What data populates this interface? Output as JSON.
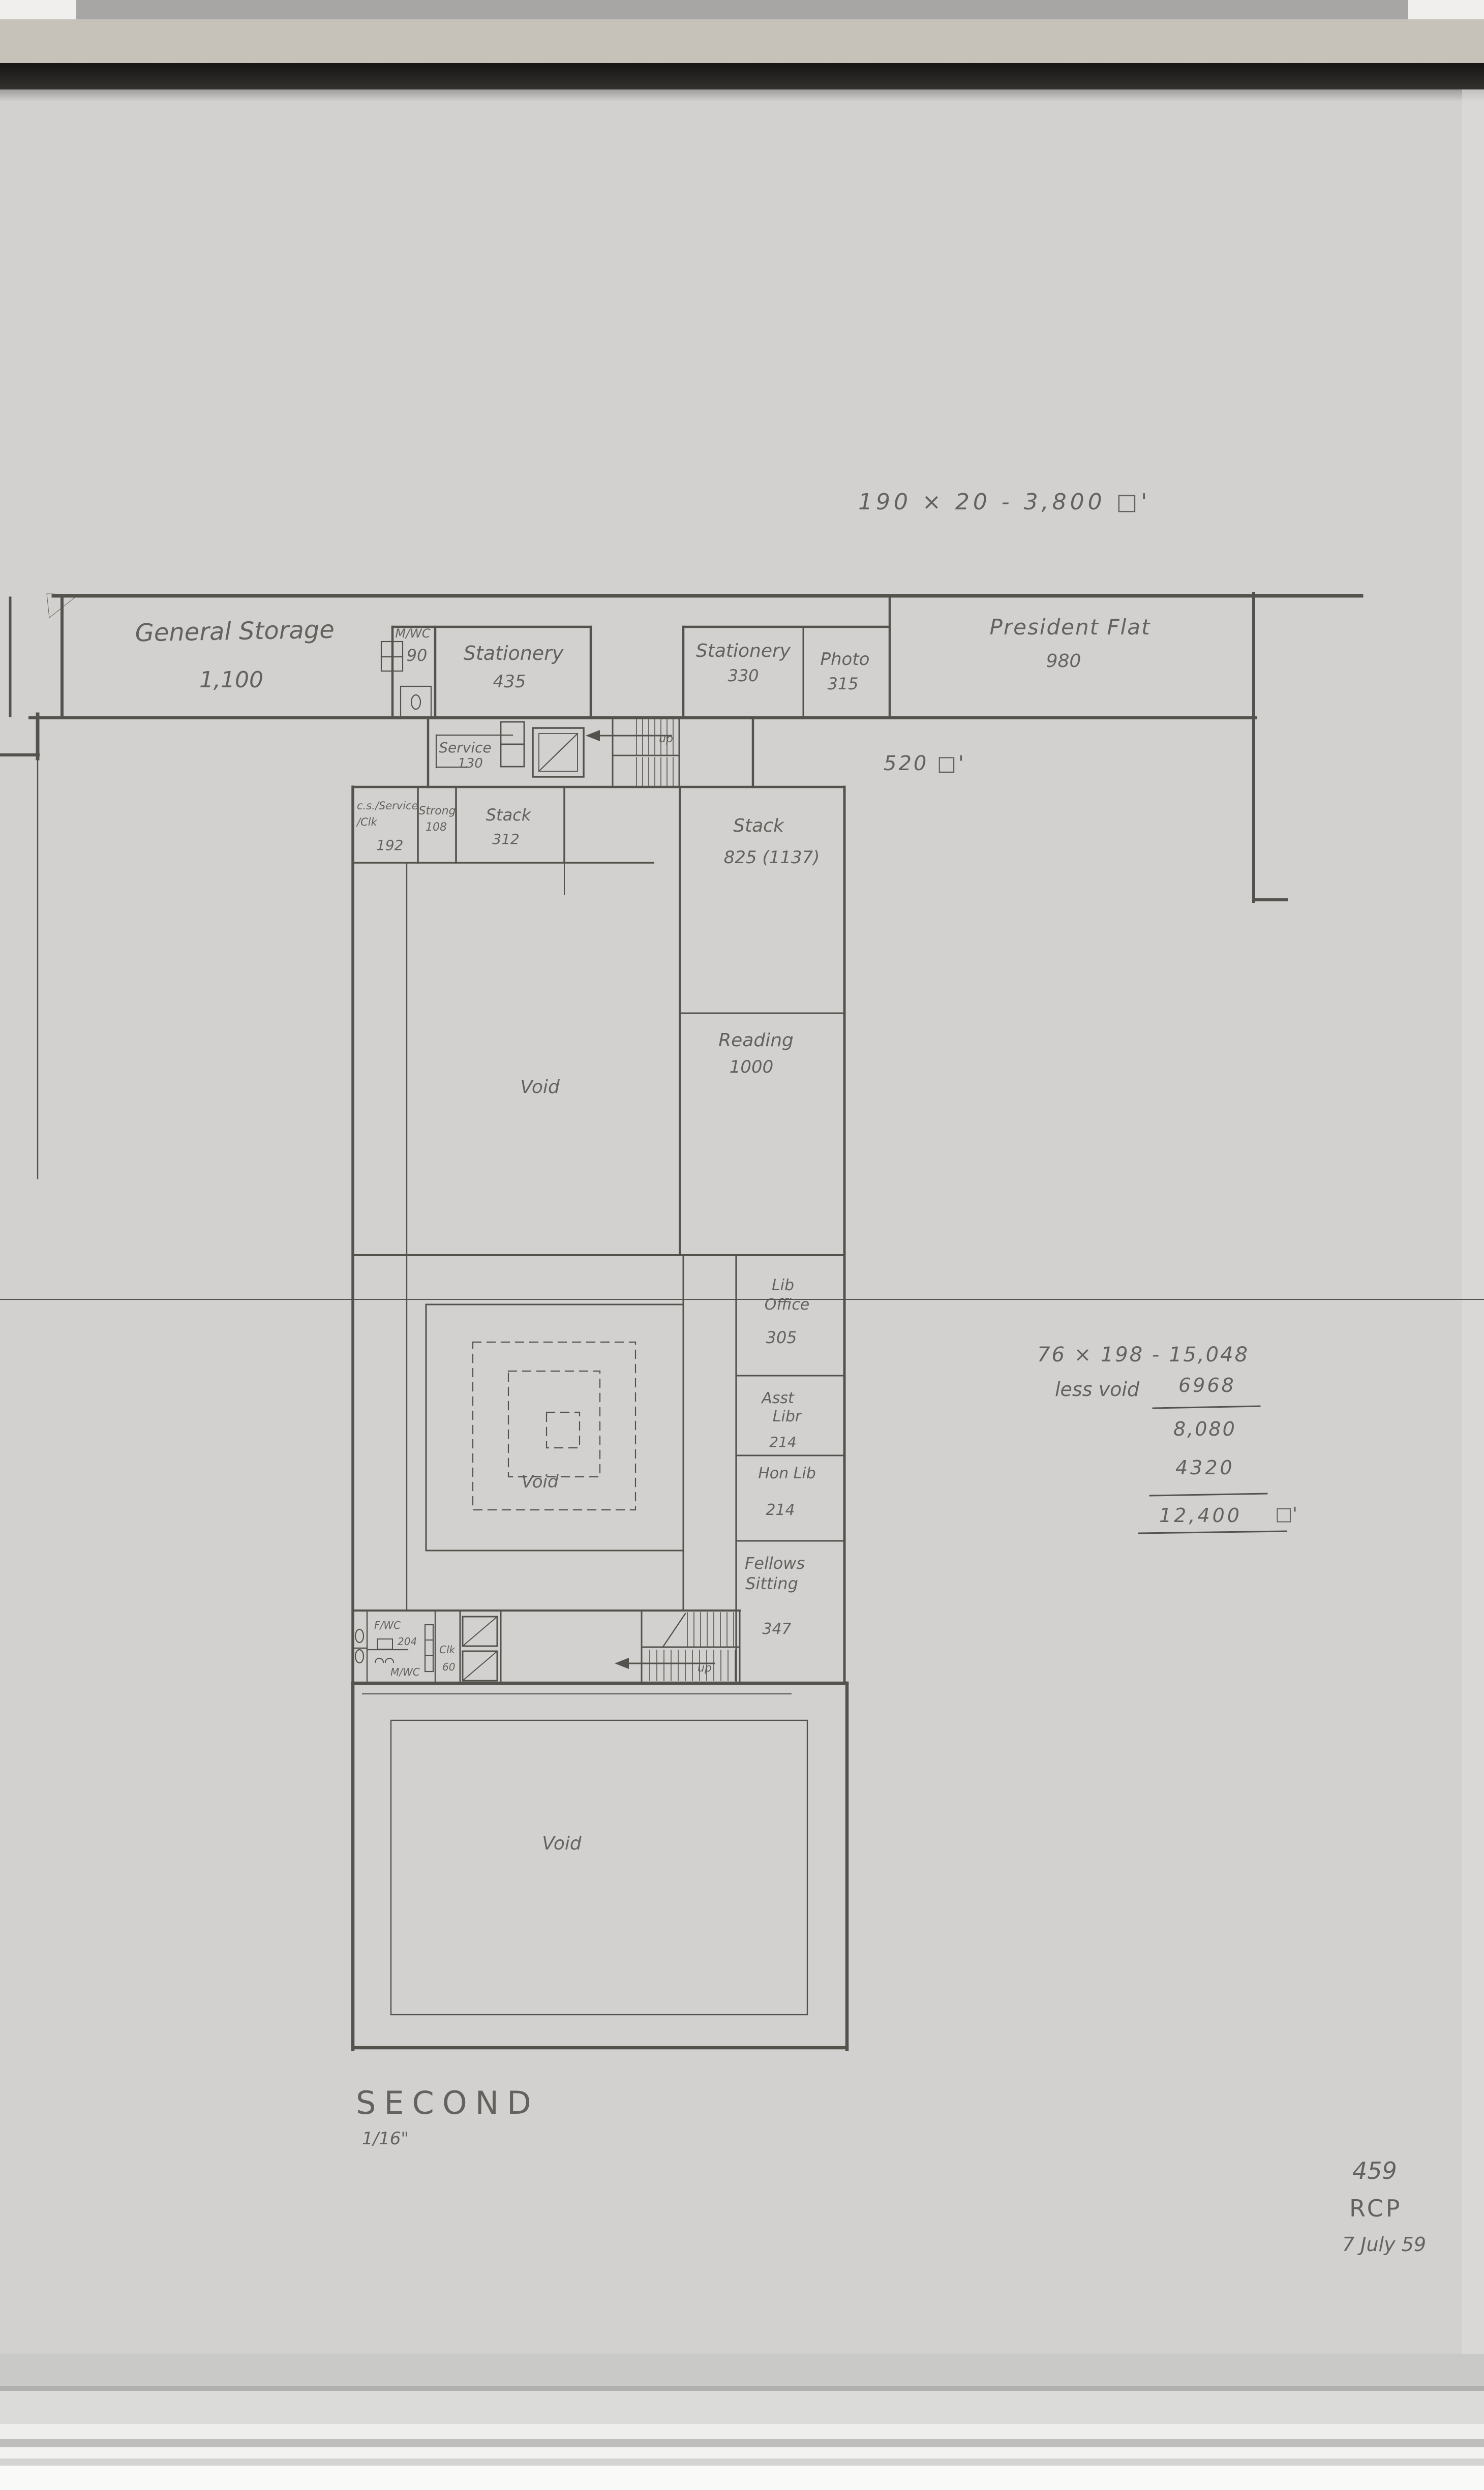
{
  "annotations": {
    "top_calc": "190 × 20   -    3,800 □'",
    "corridor_area": "520 □'",
    "side_calc": {
      "line1": "76 × 198  -   15,048",
      "less_void_label": "less void",
      "less_void_value": "6968",
      "subtotal": "8,080",
      "deduction": "4320",
      "total": "12,400",
      "total_unit": "□'"
    }
  },
  "rooms": {
    "general_storage": {
      "name": "General Storage",
      "area": "1,100"
    },
    "mwc_upper": {
      "name": "M/WC",
      "area": "90"
    },
    "stationery_west": {
      "name": "Stationery",
      "area": "435"
    },
    "stationery_east": {
      "name": "Stationery",
      "area": "330"
    },
    "photo": {
      "name": "Photo",
      "area": "315"
    },
    "president_flat": {
      "name": "President Flat",
      "area": "980"
    },
    "service": {
      "name": "Service",
      "area": "130"
    },
    "cs_service_clk": {
      "l1": "c.s./Service",
      "l2": "/Clk",
      "area": "192"
    },
    "strong": {
      "name": "Strong",
      "area": "108"
    },
    "stack_small": {
      "name": "Stack",
      "area": "312"
    },
    "stack_large": {
      "name": "Stack",
      "area": "825 (1137)"
    },
    "reading": {
      "name": "Reading",
      "area": "1000"
    },
    "void_upper": {
      "name": "Void"
    },
    "lib_office": {
      "l1": "Lib",
      "l2": "Office",
      "area": "305"
    },
    "asst_libr": {
      "l1": "Asst",
      "l2": "Libr",
      "area": "214"
    },
    "hon_lib": {
      "name": "Hon Lib",
      "area": "214"
    },
    "fellows_sitting": {
      "l1": "Fellows",
      "l2": "Sitting",
      "area": "347"
    },
    "fwc": {
      "name": "F/WC",
      "area": "204"
    },
    "mwc_lower": {
      "name": "M/WC"
    },
    "clk": {
      "name": "Clk",
      "area": "60"
    },
    "void_middle": {
      "name": "Void"
    },
    "void_lower": {
      "name": "Void"
    },
    "stairs_up_north": "up",
    "stairs_up_south": "up"
  },
  "title_block": {
    "floor": "SECOND",
    "scale": "1/16\""
  },
  "stamp": {
    "number": "459",
    "initials": "RCP",
    "date": "7 July 59"
  },
  "colors": {
    "paper": "#d2d1cf",
    "pencil": "#54524d",
    "handwriting": "#5b5955",
    "dark_band": "#161514"
  }
}
